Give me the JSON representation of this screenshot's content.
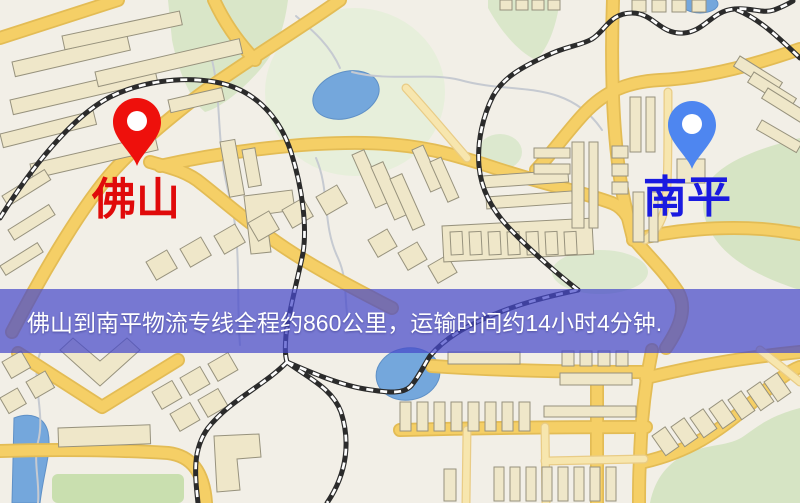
{
  "map": {
    "foshan": {
      "label": "佛山",
      "pin_color": "#EE100C",
      "label_color": "#E00A0A"
    },
    "nanping": {
      "label": "南平",
      "pin_color": "#4E86F0",
      "label_color": "#1A1AE0"
    },
    "banner": {
      "text": "佛山到南平物流专线全程约860公里，运输时间约14小时4分钟.",
      "bg_color": "rgba(70,73,202,0.72)",
      "text_color": "#FFFFFF"
    },
    "palette": {
      "background": "#F2EFE7",
      "road": "#F5CF66",
      "road_casing": "#E3BC55",
      "road_minor": "#F7E6AE",
      "building": "#EFE7C9",
      "building_outline": "#97927D",
      "green_area": "#D8E5C6",
      "water": "#74A7DC",
      "railway": "#2B2B2B"
    }
  }
}
